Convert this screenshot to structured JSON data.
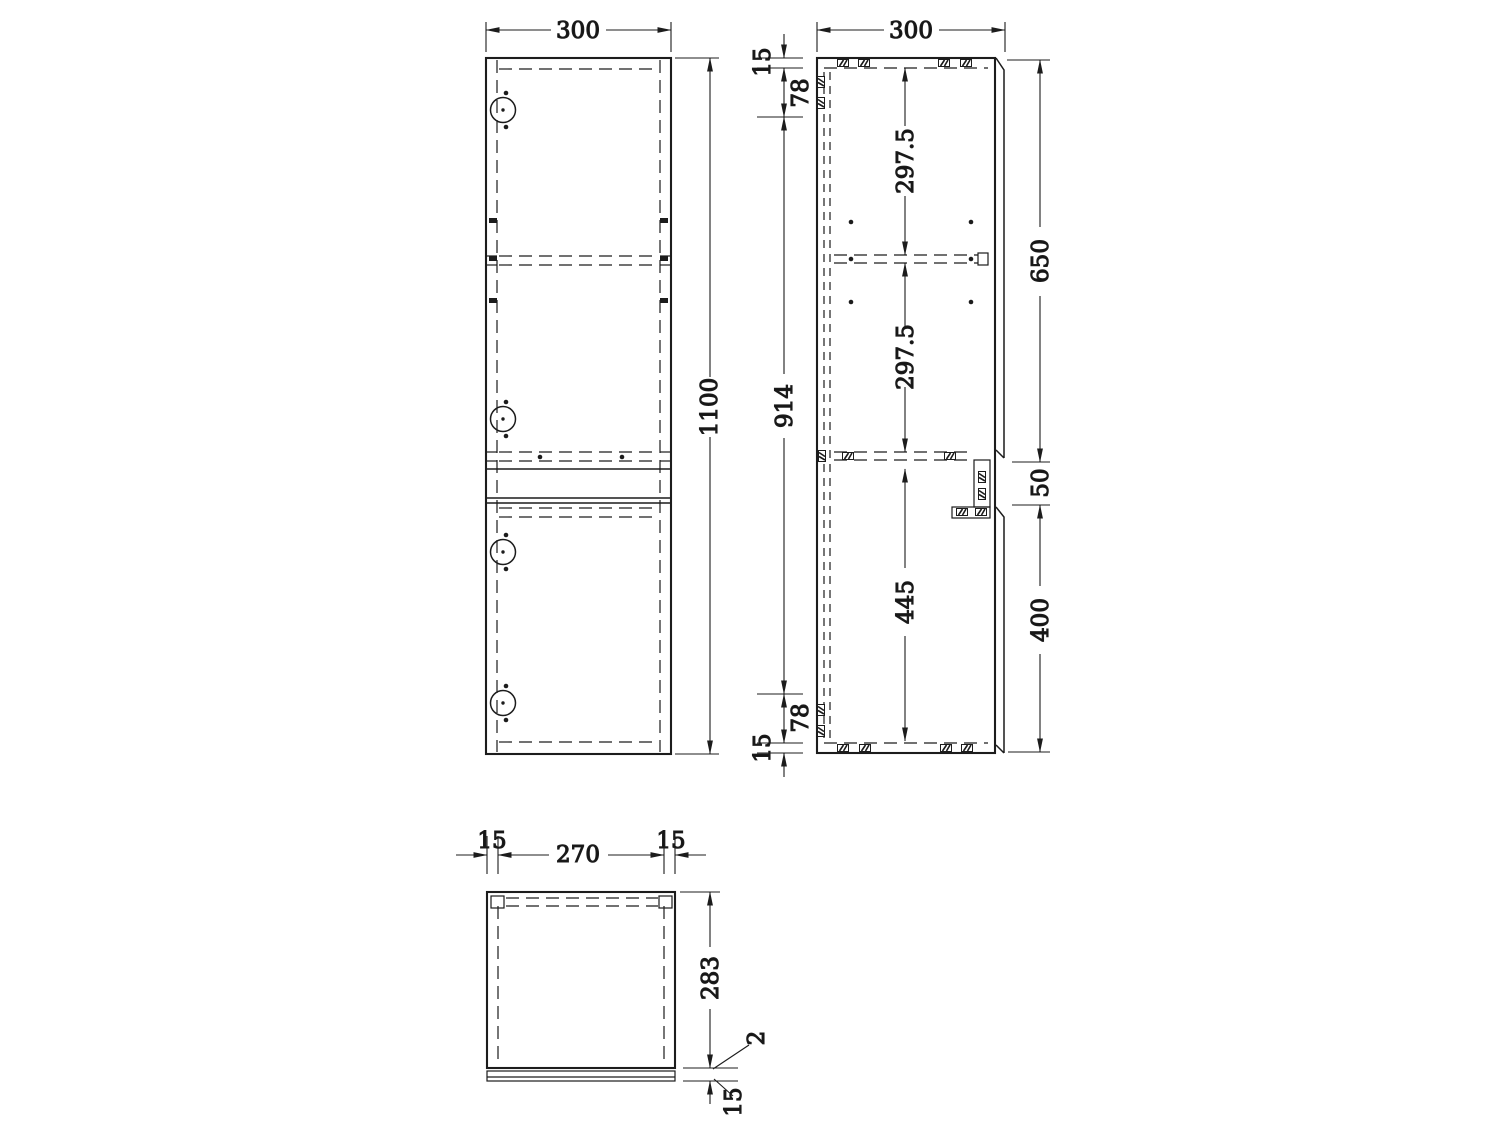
{
  "drawing": {
    "background": "#ffffff",
    "line_color": "#1c1c1c",
    "front_view": {
      "width": "300",
      "height": "1100"
    },
    "side_view": {
      "width": "300",
      "top_thickness": "15",
      "top_offset": "78",
      "back_interior_height": "914",
      "bottom_offset": "78",
      "bottom_thickness": "15",
      "upper_shelf_spacing": "297.5",
      "middle_shelf_spacing": "297.5",
      "lower_interior": "445",
      "upper_door_height": "650",
      "center_gap": "50",
      "lower_door_height": "400"
    },
    "top_view": {
      "left_panel_thickness": "15",
      "interior_width": "270",
      "right_panel_thickness": "15",
      "body_depth": "283",
      "door_gap": "2",
      "door_thickness": "15"
    }
  }
}
